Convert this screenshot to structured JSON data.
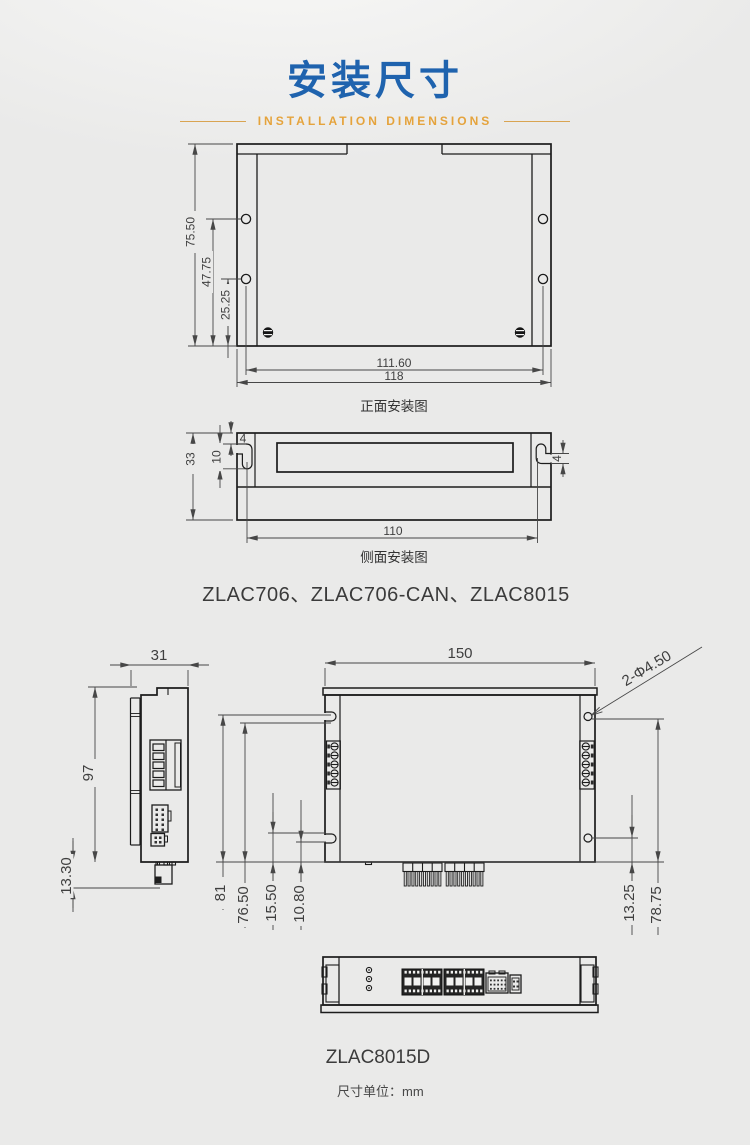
{
  "header": {
    "title": "安装尺寸",
    "subtitle": "INSTALLATION DIMENSIONS",
    "title_color": "#1f63ae",
    "accent_color": "#e5a33c"
  },
  "front_view": {
    "caption": "正面安装图",
    "dim_height": "75.50",
    "dim_hole_upper": "47.75",
    "dim_hole_lower": "25.25",
    "dim_hole_span": "111.60",
    "dim_width": "118"
  },
  "side_view": {
    "caption": "侧面安装图",
    "dim_height": "33",
    "dim_slot_depth": "10",
    "dim_slot_offset": "4",
    "dim_slot_height": "4",
    "dim_slot_span": "110"
  },
  "models_group1": "ZLAC706、ZLAC706-CAN、ZLAC8015",
  "m8015d": {
    "side": {
      "dim_width": "31",
      "dim_height": "97",
      "dim_tab": "13.30"
    },
    "front": {
      "dim_width": "150",
      "dim_holes": "2-Φ4.50",
      "dim_slot_top_a": "81",
      "dim_slot_top_b": "76.50",
      "dim_slot_bot_a": "15.50",
      "dim_slot_bot_b": "10.80",
      "dim_hole_bot": "13.25",
      "dim_hole_top": "78.75"
    },
    "label": "ZLAC8015D"
  },
  "footer": {
    "unit_note": "尺寸单位：mm"
  }
}
